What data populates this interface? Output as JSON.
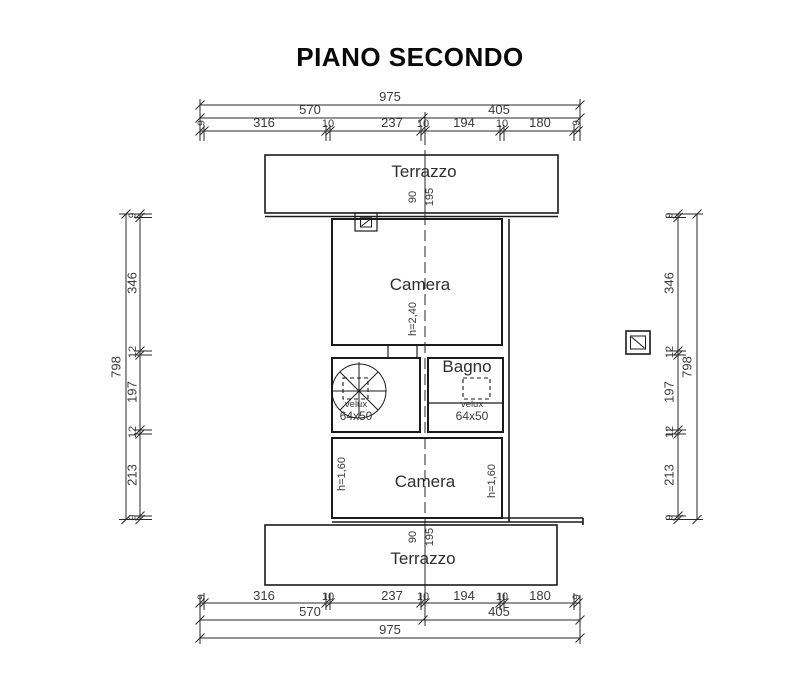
{
  "title": "PIANO SECONDO",
  "plan": {
    "terrace_top_label": "Terrazzo",
    "camera_top_label": "Camera",
    "camera_top_height": "h=2,40",
    "bagno_label": "Bagno",
    "stairs_velux_label": "velux",
    "stairs_velux_size": "64x50",
    "bagno_velux_label": "velux",
    "bagno_velux_size": "64x50",
    "camera_bottom_label": "Camera",
    "camera_bottom_height_left": "h=1,60",
    "camera_bottom_height_right": "h=1,60",
    "terrace_bottom_label": "Terrazzo"
  },
  "dims": {
    "top": {
      "total": "975",
      "left_mid": "570",
      "right_mid": "405",
      "seg": [
        "9",
        "316",
        "10",
        "237",
        "10",
        "194",
        "10",
        "180",
        "9"
      ]
    },
    "bottom": {
      "total": "975",
      "left_mid": "570",
      "right_mid": "405",
      "seg": [
        "9",
        "316",
        "10",
        "237",
        "10",
        "194",
        "10",
        "180",
        "9"
      ]
    },
    "left": {
      "total": "798",
      "seg": [
        "9",
        "346",
        "12",
        "197",
        "12",
        "213",
        "9"
      ]
    },
    "right": {
      "total": "798",
      "seg": [
        "9",
        "346",
        "12",
        "197",
        "12",
        "213",
        "9"
      ]
    },
    "axis_top": {
      "a": "90",
      "b": "195"
    },
    "axis_bottom": {
      "a": "90",
      "b": "195"
    }
  },
  "colors": {
    "line": "#1b1b1b",
    "text": "#3a3a3a"
  }
}
